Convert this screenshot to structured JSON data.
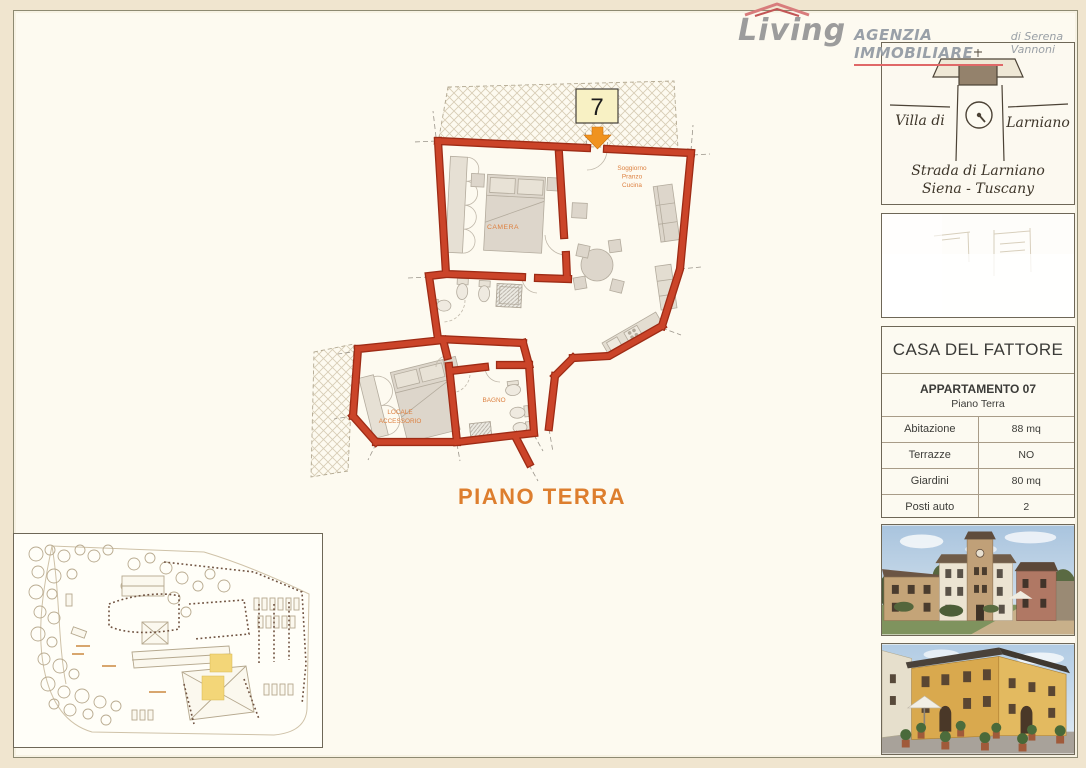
{
  "logo": {
    "brand": "Living",
    "tagline": "AGENZIA IMMOBILIARE",
    "subtitle": "di Serena Vannoni"
  },
  "villa_card": {
    "name_left": "Villa di",
    "name_right": "Larniano",
    "address_line1": "Strada di Larniano",
    "address_line2": "Siena - Tuscany"
  },
  "info_card": {
    "title": "CASA DEL FATTORE",
    "subtitle": "APPARTAMENTO 07",
    "floor": "Piano Terra",
    "rows": [
      {
        "label": "Abitazione",
        "value": "88 mq"
      },
      {
        "label": "Terrazze",
        "value": "NO"
      },
      {
        "label": "Giardini",
        "value": "80 mq"
      },
      {
        "label": "Posti auto",
        "value": "2"
      }
    ]
  },
  "floorplan": {
    "unit_badge": "7",
    "caption": "PIANO TERRA",
    "labels": {
      "camera": "CAMERA",
      "soggiorno_lines": [
        "Soggiorno",
        "Pranzo",
        "Cucina"
      ],
      "locale_lines": [
        "LOCALE",
        "ACCESSORIO"
      ],
      "bagno": "BAGNO"
    }
  },
  "colors": {
    "wall_red": "#c7402a",
    "wall_red_dark": "#9e2b15",
    "room_label_orange": "#dd8040",
    "caption_orange": "#dd7e2e",
    "badge_yellow": "#f8f1c4",
    "arrow_orange": "#f0931f",
    "siteplan_highlight_yellow": "#f3d678",
    "logo_red": "#e06868",
    "page_cream": "#fdfaf0"
  }
}
